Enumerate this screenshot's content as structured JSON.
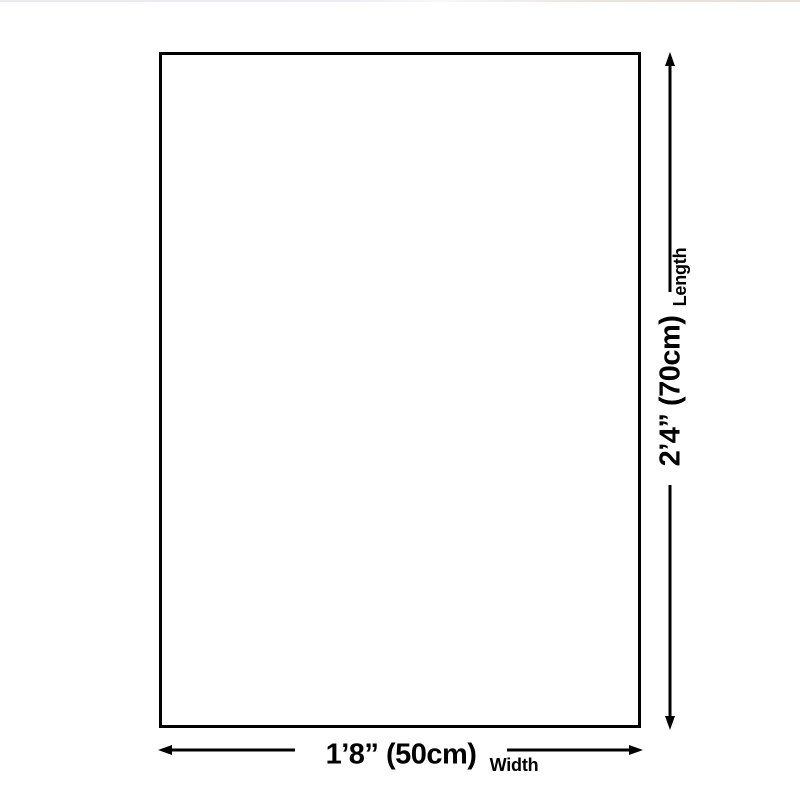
{
  "diagram": {
    "length": {
      "value": "2’4” (70cm)",
      "label": "Length"
    },
    "width": {
      "value": "1’8” (50cm)",
      "label": "Width"
    },
    "colors": {
      "line": "#000000",
      "background": "#ffffff",
      "page_top_edge": "#eae8f1"
    }
  }
}
